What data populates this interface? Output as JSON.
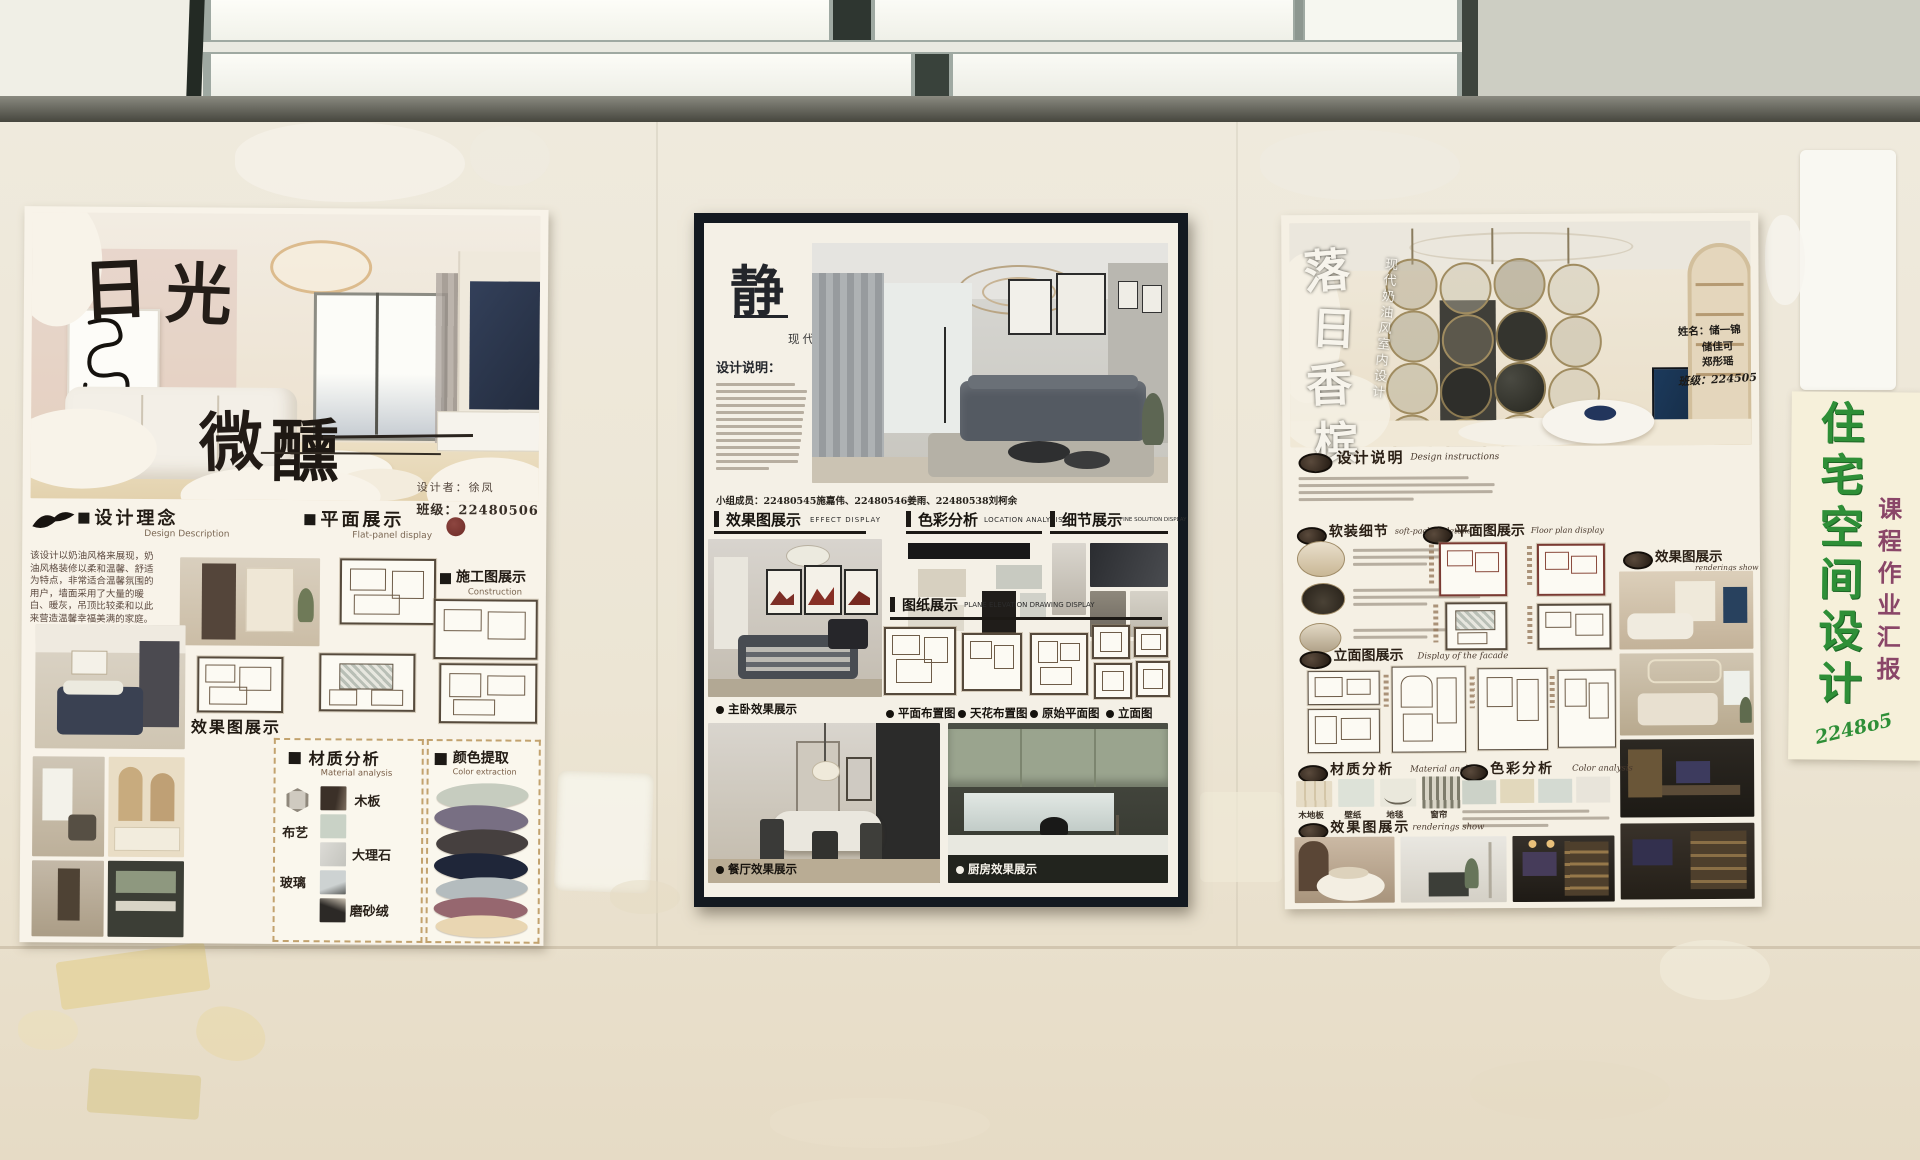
{
  "poster_left": {
    "title": "日光微醺",
    "title_chars": [
      "日",
      "光",
      "微",
      "醺"
    ],
    "designer": "设计者：徐凤",
    "class_no": "班级：22480506",
    "sec": {
      "concept_zh": "设计理念",
      "concept_en": "Design Description",
      "plan_zh": "平面展示",
      "plan_en": "Flat-panel display",
      "constr_zh": "施工图展示",
      "constr_en1": "Construction",
      "constr_en2": "drawings show",
      "effect_zh": "效果图展示",
      "material_zh": "材质分析",
      "material_en": "Material analysis",
      "color_zh": "颜色提取",
      "color_en": "Color extraction"
    },
    "concept_text": "该设计以奶油风格来展现，奶油风格装修以柔和温馨、舒适为特点，非常适合温馨氛围的用户，墙面采用了大量的暖白、暖灰，吊顶比较柔和以此来营造温馨幸福美满的家庭。",
    "materials": [
      "布艺",
      "木板",
      "大理石",
      "玻璃",
      "磨砂绒"
    ]
  },
  "poster_middle": {
    "title": "静谧",
    "subtitle": "现代简约方案设计",
    "desc_label": "设计说明：",
    "team": "小组成员：22480545施嘉伟、22480546姜雨、22480538刘柯余",
    "sec": {
      "effect_zh": "效果图展示",
      "effect_en": "EFFECT DISPLAY",
      "color_zh": "色彩分析",
      "color_en": "LOCATION ANALYSIS",
      "detail_zh": "细节展示",
      "detail_en": "FINE SOLUTION DISPLAY",
      "drawing_zh": "图纸展示",
      "drawing_en": "PLANE ELEVATION DRAWING DISPLAY"
    },
    "plan_labels": [
      "平面布置图",
      "天花布置图",
      "原始平面图",
      "立面图"
    ],
    "labels": {
      "master": "主卧效果展示",
      "dining": "餐厅效果展示",
      "kitchen": "厨房效果展示"
    }
  },
  "poster_right": {
    "title": "落日香槟",
    "title_chars": [
      "落",
      "日",
      "香",
      "槟"
    ],
    "subtitle": "现代奶油风室内设计",
    "names": [
      "姓名：储一锦",
      "储佳可",
      "郑彤瑶",
      "班级：224505"
    ],
    "sec": {
      "desc_zh": "设计说明",
      "desc_en": "Design instructions",
      "soft_zh": "软装细节",
      "soft_en": "soft-packed details",
      "floor_zh": "平面图展示",
      "floor_en": "Floor plan display",
      "effect_zh": "效果图展示",
      "effect_en": "renderings show",
      "facade_zh": "立面图展示",
      "facade_en": "Display of the facade",
      "material_zh": "材质分析",
      "material_en": "Material analysis",
      "color_zh": "色彩分析",
      "color_en": "Color analysis",
      "effect2_zh": "效果图展示",
      "effect2_en": "renderings show"
    },
    "materials": [
      "木地板",
      "壁纸",
      "地毯",
      "窗帘"
    ]
  },
  "side_sign": {
    "main": "住宅空间设计",
    "sub": "课程作业汇报",
    "code": "2248o5"
  },
  "colors": {
    "sign_green": "#2e8f37",
    "sign_purple": "#8a4668",
    "left_palette": [
      "#c6ccbf",
      "#786f83",
      "#46403f",
      "#1f2639",
      "#b4bcbe",
      "#96676f",
      "#e9d6b2"
    ],
    "middle_swatches": [
      "#d7d0c0",
      "#c8cac1",
      "#ded9cc",
      "#201d1a",
      "#d0d1c9"
    ],
    "right_swatches": [
      "#ccd2c8",
      "#e2d8bc",
      "#d4dad2",
      "#e8e4da"
    ]
  }
}
